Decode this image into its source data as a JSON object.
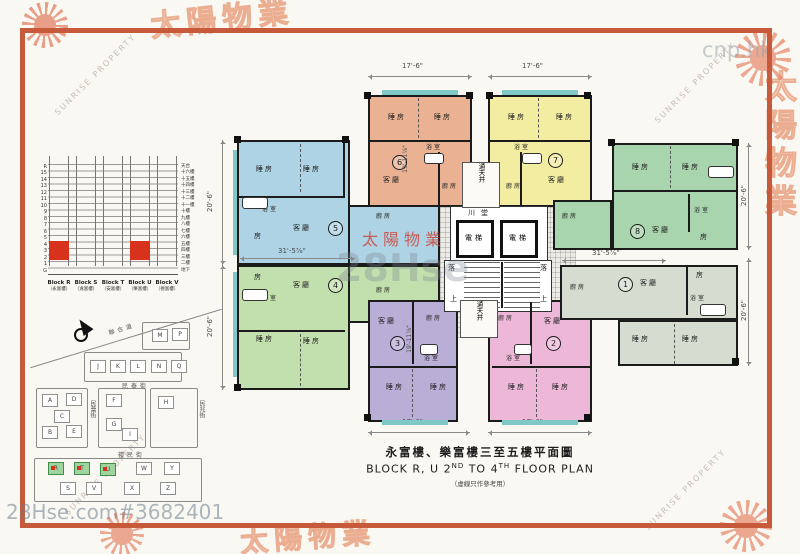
{
  "frame": {
    "cnp_watermark": "cnp.hk",
    "listing_watermark": "28Hse.com#3682401",
    "sunrise_en": "SUNRISE PROPERTY",
    "sunrise_cn": "太陽物業",
    "center_red": "太陽物業",
    "center_gray": "28Hse"
  },
  "title": {
    "cn": "永富樓、樂富樓三至五樓平面圖",
    "en_a": "BLOCK R, U 2",
    "en_b": "ND",
    "en_c": " TO 4",
    "en_d": "TH",
    "en_e": " FLOOR PLAN",
    "note": "（虛線只作參考用）"
  },
  "elevation": {
    "rows": [
      {
        "l": "R",
        "r": "天台"
      },
      {
        "l": "15",
        "r": "十六樓"
      },
      {
        "l": "14",
        "r": "十五樓"
      },
      {
        "l": "13",
        "r": "十四樓"
      },
      {
        "l": "12",
        "r": "十三樓"
      },
      {
        "l": "11",
        "r": "十二樓"
      },
      {
        "l": "10",
        "r": "十一樓"
      },
      {
        "l": "9",
        "r": "十樓"
      },
      {
        "l": "8",
        "r": "九樓"
      },
      {
        "l": "7",
        "r": "八樓"
      },
      {
        "l": "6",
        "r": "七樓"
      },
      {
        "l": "5",
        "r": "六樓"
      },
      {
        "l": "4",
        "r": "五樓"
      },
      {
        "l": "3",
        "r": "四樓"
      },
      {
        "l": "2",
        "r": "三樓"
      },
      {
        "l": "1",
        "r": "二樓"
      },
      {
        "l": "G",
        "r": "地下"
      }
    ],
    "blocks": [
      {
        "en": "Block R",
        "cn": "（永富樓）"
      },
      {
        "en": "Block S",
        "cn": "（逸富樓）"
      },
      {
        "en": "Block T",
        "cn": "（安富樓）"
      },
      {
        "en": "Block U",
        "cn": "（樂富樓）"
      },
      {
        "en": "Block V",
        "cn": "（德富樓）"
      }
    ]
  },
  "site_map": {
    "streets": {
      "diagonal": "聯合道",
      "mid": "民泰街",
      "left_v": "民蕾街",
      "bottom": "禮民街",
      "right_v": "民兆街"
    },
    "buildings": [
      "M",
      "P",
      "J",
      "K",
      "L",
      "N",
      "Q",
      "A",
      "D",
      "C",
      "B",
      "E",
      "F",
      "G",
      "I",
      "H",
      "R",
      "T",
      "U",
      "W",
      "Y",
      "S",
      "V",
      "X",
      "Z"
    ]
  },
  "plan": {
    "dims": {
      "w17": "17'-6\"",
      "d20": "20'-6\"",
      "d31": "31'-5⅞\"",
      "d19": "19'-11⅞\""
    },
    "core": {
      "lobby": "川堂",
      "lift": "電梯",
      "down": "落",
      "up": "上",
      "lightwell": "通天井"
    },
    "rooms": {
      "bed": "睡房",
      "living": "客廳",
      "bath": "浴室",
      "kitchen": "廚房",
      "room": "房"
    },
    "units": [
      {
        "no": "1"
      },
      {
        "no": "2"
      },
      {
        "no": "3"
      },
      {
        "no": "4"
      },
      {
        "no": "5"
      },
      {
        "no": "6"
      },
      {
        "no": "7"
      },
      {
        "no": "8"
      }
    ]
  }
}
